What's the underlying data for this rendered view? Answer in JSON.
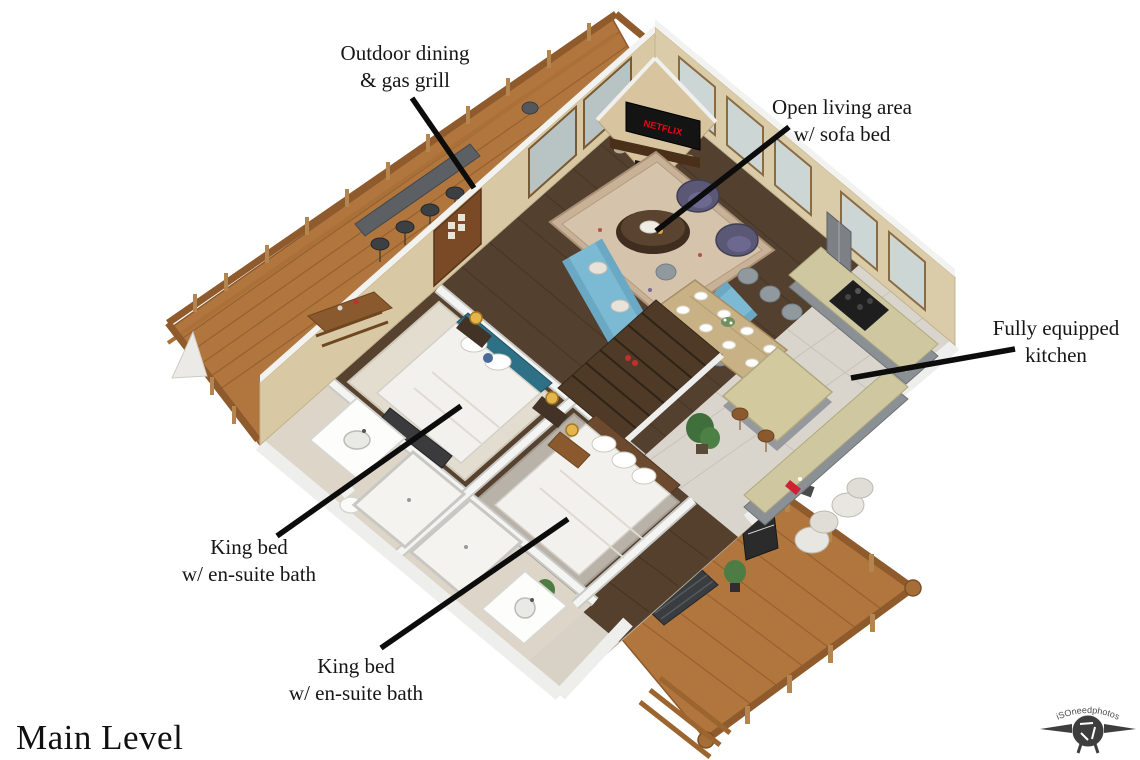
{
  "title": "Main Level",
  "watermark": "iSOneedphotos",
  "tv_brand": "NETFLIX",
  "annotations": [
    {
      "line1": "Outdoor dining",
      "line2": "& gas grill"
    },
    {
      "line1": "Open living area",
      "line2": "w/ sofa bed"
    },
    {
      "line1": "Fully equipped",
      "line2": "kitchen"
    },
    {
      "line1": "King bed",
      "line2": "w/ en-suite bath"
    },
    {
      "line1": "King bed",
      "line2": "w/ en-suite bath"
    }
  ],
  "colors": {
    "deck_wood": "#b0763e",
    "interior_wood": "#53402e",
    "stone_wall": "#dbcca9",
    "tile": "#d9d5cc",
    "granite": "#cfc79f",
    "cabinet_gray": "#8b9094",
    "sofa_blue": "#7cb9d3",
    "headboard_teal": "#2e7086",
    "armchair_purple": "#5b5876",
    "netflix_red": "#e50914",
    "label_text": "#161616"
  }
}
